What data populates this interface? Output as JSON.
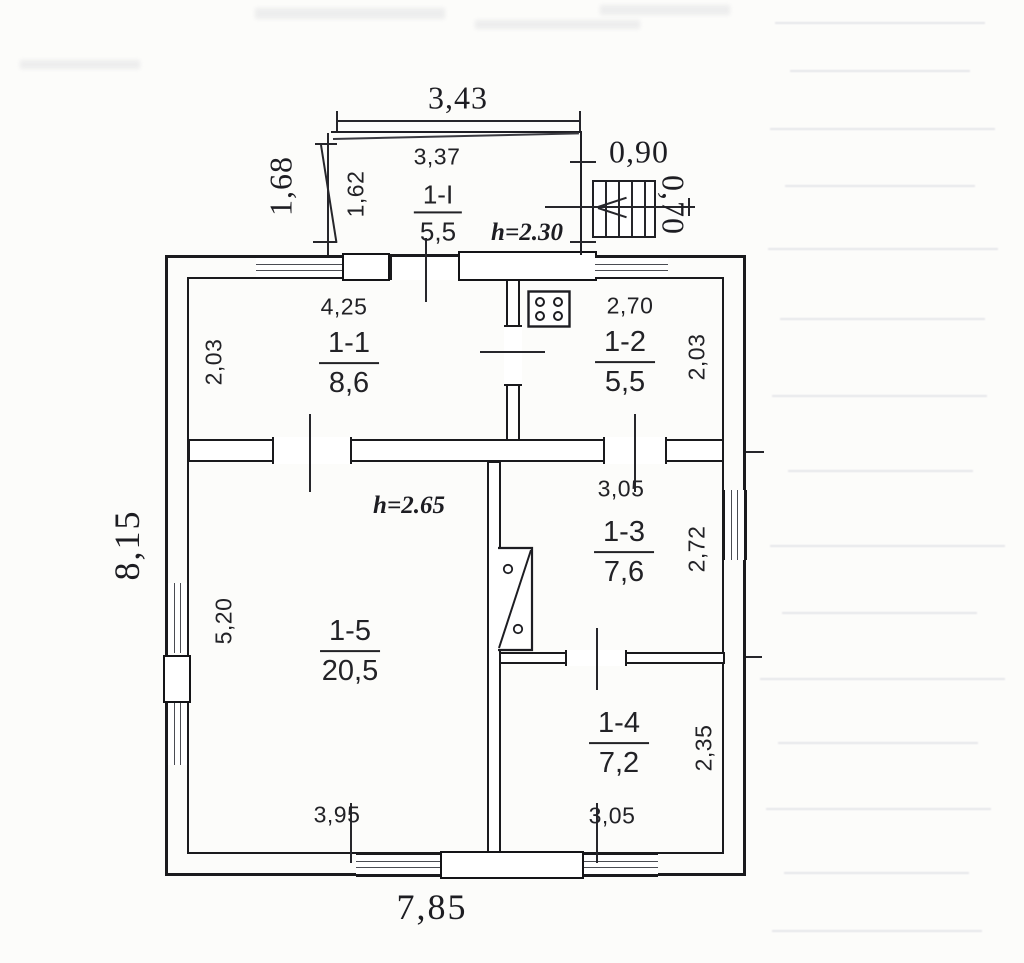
{
  "plan": {
    "overall": {
      "width_label": "7,85",
      "height_label": "8,15"
    },
    "vestibule": {
      "room_id": "1-I",
      "area": "5,5",
      "ceiling_height": "h=2.30",
      "outer_width": "3,43",
      "inner_width": "3,37",
      "outer_depth": "1,68",
      "inner_depth": "1,62"
    },
    "stairs": {
      "width": "0,90",
      "depth": "0,70"
    },
    "main_ceiling_height": "h=2.65",
    "rooms": [
      {
        "room_id": "1-1",
        "area": "8,6",
        "width": "4,25",
        "depth": "2,03"
      },
      {
        "room_id": "1-2",
        "area": "5,5",
        "width": "2,70",
        "depth": "2,03"
      },
      {
        "room_id": "1-3",
        "area": "7,6",
        "width": "3,05",
        "depth": "2,72"
      },
      {
        "room_id": "1-4",
        "area": "7,2",
        "width": "3,05",
        "depth": "2,35"
      },
      {
        "room_id": "1-5",
        "area": "20,5",
        "width": "3,95",
        "depth": "5,20"
      }
    ]
  }
}
